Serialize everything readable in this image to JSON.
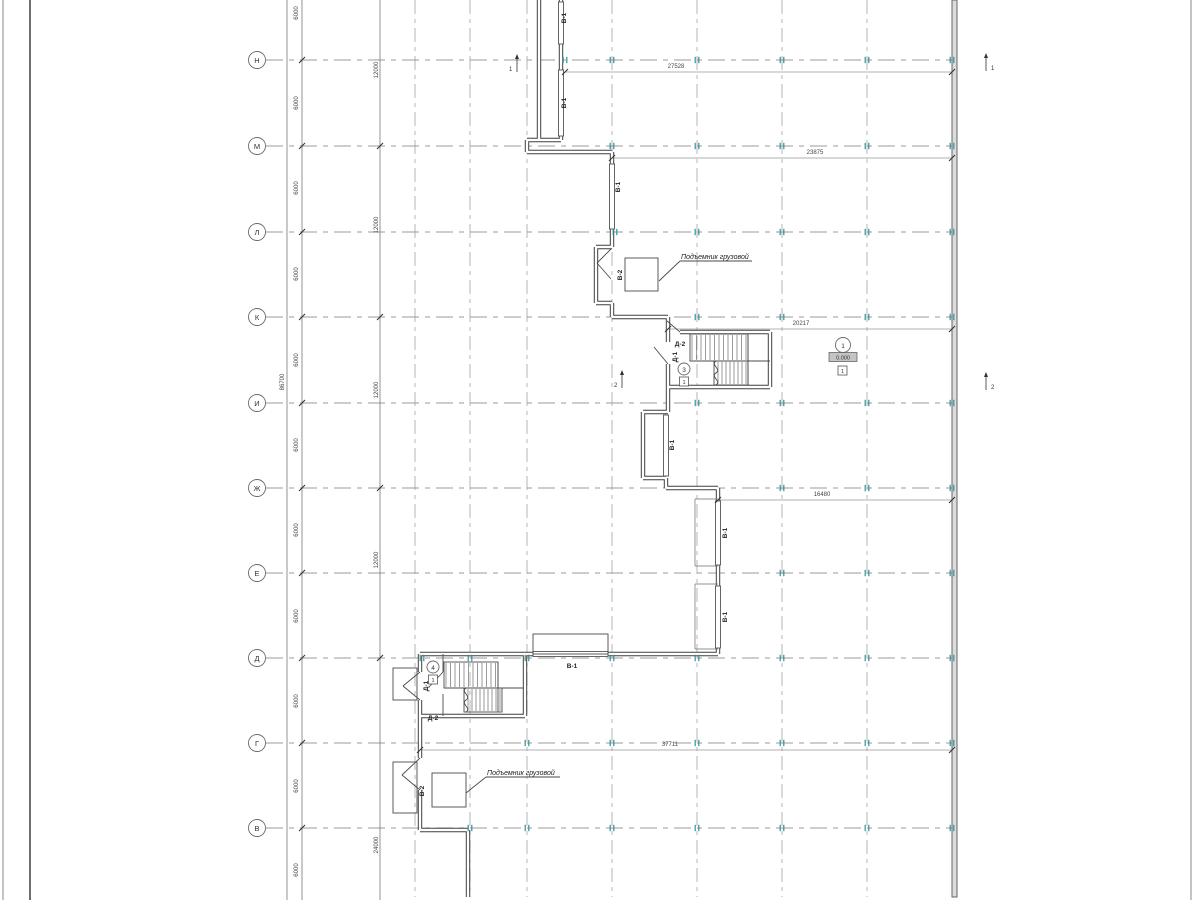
{
  "axes": {
    "labels": [
      "Н",
      "М",
      "Л",
      "К",
      "И",
      "Ж",
      "Е",
      "Д",
      "Г",
      "В"
    ]
  },
  "dimensions": {
    "bay": "6000",
    "double_bay": "12000",
    "bottom_bay": "24000",
    "total_height": "86700",
    "width_1": "27528",
    "width_2": "23875",
    "width_3": "20217",
    "width_4": "16480",
    "width_5": "37711"
  },
  "tags": {
    "window": "В-1",
    "elevator_door": "В-2",
    "door_1": "Д-1",
    "door_2": "Д-2"
  },
  "annotations": {
    "freight_elevator": "Подъемник грузовой"
  },
  "sections": {
    "s1": "1",
    "s2": "2"
  },
  "rooms": {
    "hall": {
      "number": "1",
      "elevation": "0.000",
      "floor_type": "1"
    },
    "stair_upper": {
      "number": "3",
      "floor_type": "1"
    },
    "stair_lower": {
      "number": "4",
      "floor_type": "1"
    }
  },
  "colors": {
    "tick_teal": "#2f8f96",
    "wall": "#3f3f3f",
    "grid": "#9b9b9b",
    "dim_text": "#444444"
  }
}
